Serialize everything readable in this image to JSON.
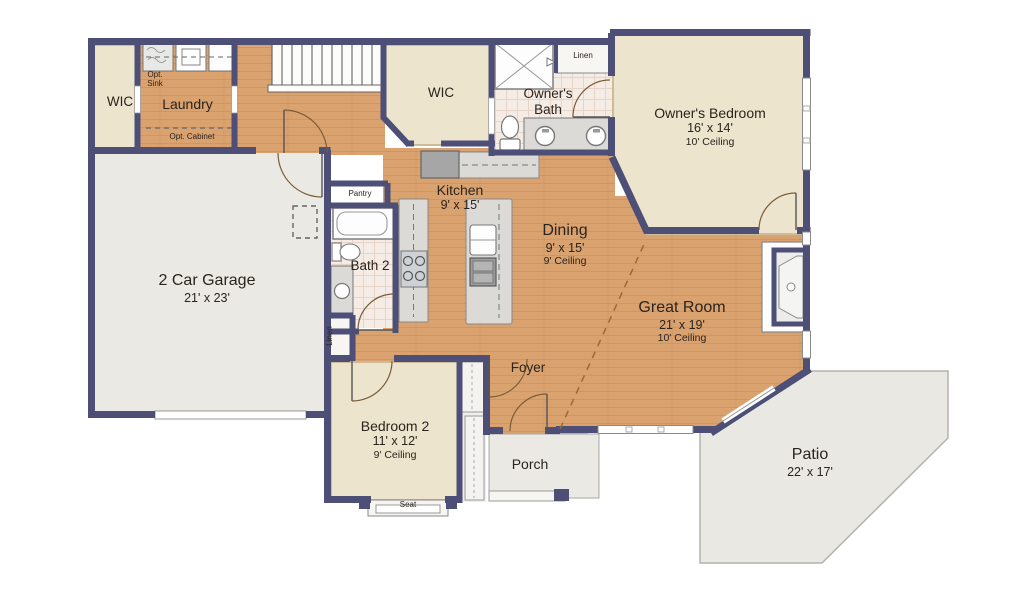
{
  "rooms": {
    "wic_left": {
      "name": "WIC"
    },
    "laundry": {
      "name": "Laundry"
    },
    "wic_center": {
      "name": "WIC"
    },
    "owners_bath": {
      "name": "Owner's Bath"
    },
    "owners_bedroom": {
      "name": "Owner's Bedroom",
      "dims": "16' x 14'",
      "ceiling": "10' Ceiling"
    },
    "kitchen": {
      "name": "Kitchen",
      "dims": "9' x 15'"
    },
    "pantry": {
      "name": "Pantry"
    },
    "dining": {
      "name": "Dining",
      "dims": "9' x 15'",
      "ceiling": "9' Ceiling"
    },
    "garage": {
      "name": "2 Car Garage",
      "dims": "21' x 23'"
    },
    "bath2": {
      "name": "Bath 2"
    },
    "great_room": {
      "name": "Great Room",
      "dims": "21' x 19'",
      "ceiling": "10' Ceiling"
    },
    "foyer": {
      "name": "Foyer"
    },
    "bedroom2": {
      "name": "Bedroom 2",
      "dims": "11' x 12'",
      "ceiling": "9' Ceiling"
    },
    "porch": {
      "name": "Porch"
    },
    "patio": {
      "name": "Patio",
      "dims": "22' x 17'"
    }
  },
  "labels": {
    "linen_top": "Linen",
    "linen_hall": "Linen",
    "opt_sink": "Opt. Sink",
    "opt_cabinet": "Opt. Cabinet",
    "seat": "Seat"
  },
  "colors": {
    "wall": "#4d4f76",
    "wood_floor": "#daa26f",
    "carpet": "#ece4cd",
    "tile": "#f5ece5",
    "concrete": "#eae9e4",
    "counter": "#dbdad6",
    "appliance": "#a6a6a6",
    "text": "#2a241d"
  }
}
